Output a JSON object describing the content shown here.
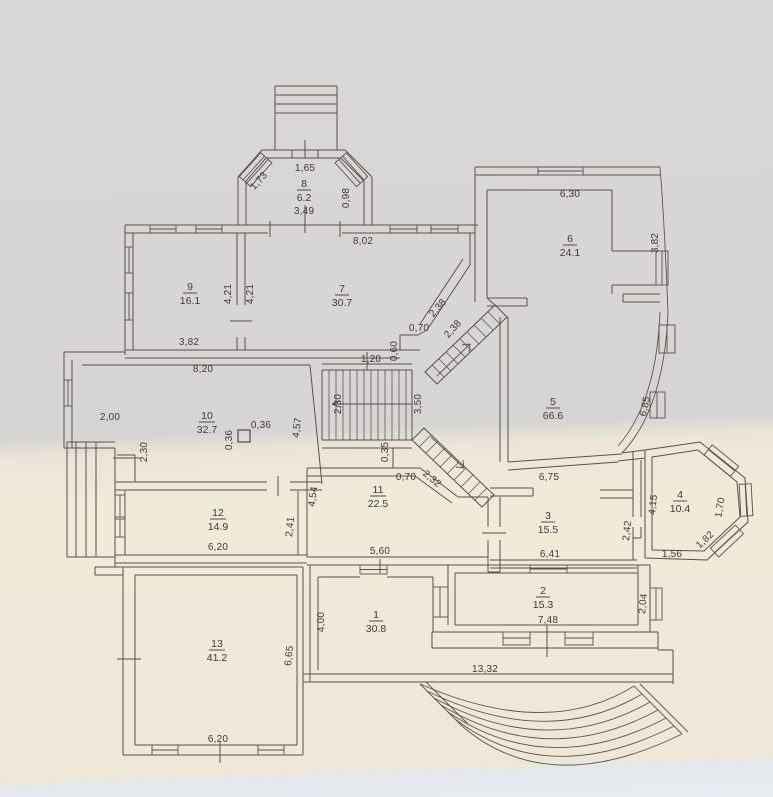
{
  "plan": {
    "type": "floor-plan",
    "rooms": [
      {
        "number": "1",
        "area": "30.8"
      },
      {
        "number": "2",
        "area": "15.3"
      },
      {
        "number": "3",
        "area": "15.5"
      },
      {
        "number": "4",
        "area": "10.4"
      },
      {
        "number": "5",
        "area": "66.6"
      },
      {
        "number": "6",
        "area": "24.1"
      },
      {
        "number": "7",
        "area": "30.7"
      },
      {
        "number": "8",
        "area": "6.2"
      },
      {
        "number": "9",
        "area": "16.1"
      },
      {
        "number": "10",
        "area": "32.7"
      },
      {
        "number": "11",
        "area": "22.5"
      },
      {
        "number": "12",
        "area": "14.9"
      },
      {
        "number": "13",
        "area": "41.2"
      }
    ],
    "dims": {
      "porch_top": "1,65",
      "porch_left": "1,73",
      "porch_right": "0,98",
      "porch_bottom": "3,49",
      "r7_top": "8,02",
      "r6_top": "6,30",
      "r6_right": "3,82",
      "r9_wall_a": "4,21",
      "r9_wall_b": "4,21",
      "r9_bottom": "3,82",
      "flight_a": "2,38",
      "flight_b": "2,38",
      "step_h": "0,70",
      "step_v": "0,60",
      "r5_right": "6,85",
      "r10_top": "8,20",
      "r10_left": "2,00",
      "col_w": "0,36",
      "col_h": "0,36",
      "r10_diag": "4,57",
      "stair_w": "1,20",
      "stair_len": "2,30",
      "stair_r": "3,50",
      "nook": "2,30",
      "step_v2": "0,35",
      "step_h2": "0,70",
      "flight_c": "2,32",
      "r11_left": "4,54",
      "r12_right": "2,41",
      "r12_bottom": "6,20",
      "r11_bottom": "5,60",
      "r3_top": "6,75",
      "r3_bottom": "6,41",
      "w34": "2,42",
      "r4_left": "4,15",
      "r4_right": "1,70",
      "r4_diag": "1,82",
      "r4_bottom": "1,56",
      "r2_right": "2,04",
      "r2_bottom": "7,48",
      "r1_left": "4,00",
      "r13_right": "6,65",
      "r13_bottom": "6,20",
      "terrace": "13,32"
    }
  }
}
